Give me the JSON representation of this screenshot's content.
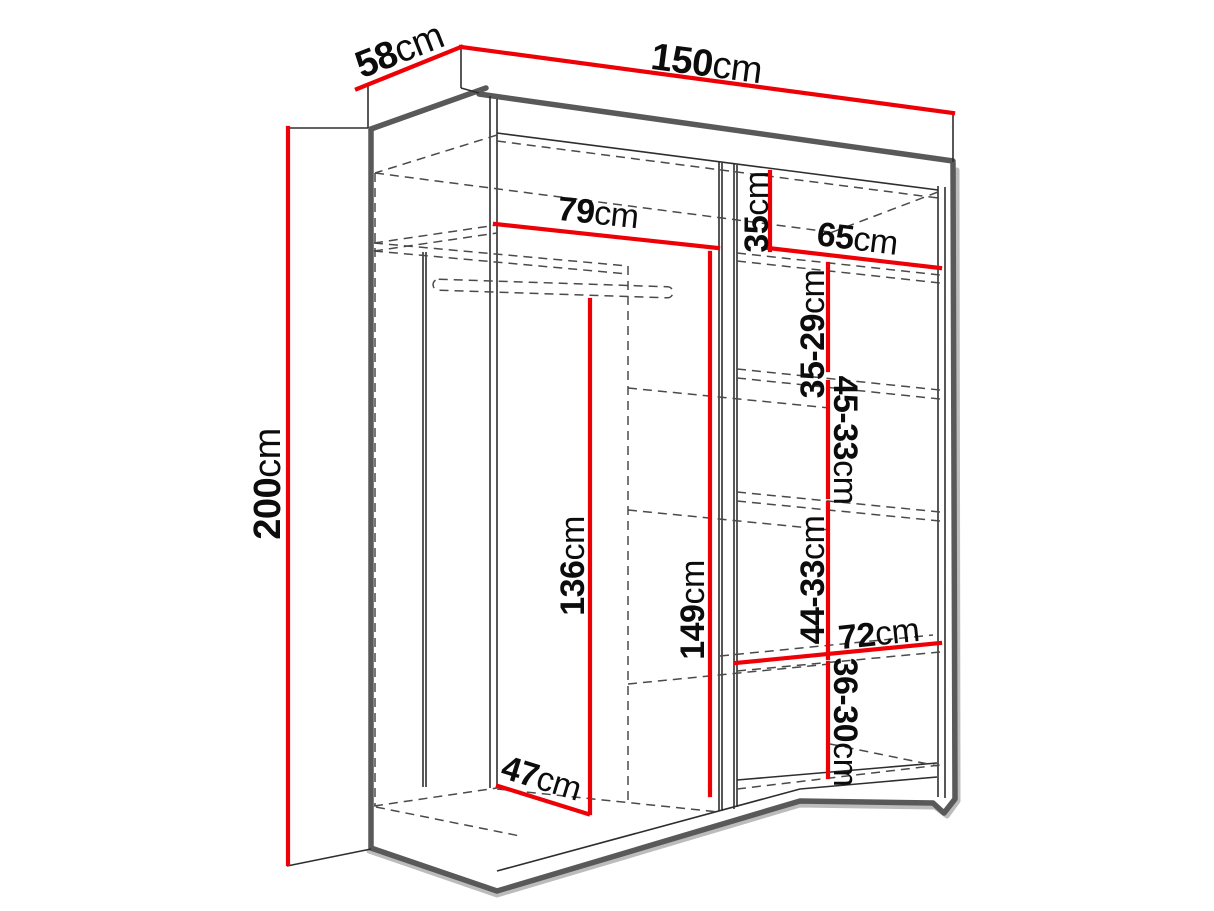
{
  "diagram": {
    "type": "furniture-dimension-diagram",
    "subject": "wardrobe interior line drawing with red dimension lines",
    "unit": "cm",
    "colors": {
      "dimension_line": "#ee0007",
      "outline": "#595959",
      "thin_line": "#2e2e2e",
      "hidden_line": "#4a4a4a",
      "label_text": "#0c0c0c",
      "background": "#ffffff"
    },
    "dims": {
      "width": {
        "value": "150",
        "unit": "cm"
      },
      "depth": {
        "value": "58",
        "unit": "cm"
      },
      "height": {
        "value": "200",
        "unit": "cm"
      },
      "left_top_width": {
        "value": "79",
        "unit": "cm"
      },
      "right_top_height": {
        "value": "35",
        "unit": "cm"
      },
      "right_width": {
        "value": "65",
        "unit": "cm"
      },
      "shelf_gap_1": {
        "value": "35-29",
        "unit": "cm"
      },
      "shelf_gap_2": {
        "value": "45-33",
        "unit": "cm"
      },
      "shelf_gap_3": {
        "value": "44-33",
        "unit": "cm"
      },
      "shelf_gap_4": {
        "value": "36-30",
        "unit": "cm"
      },
      "hanging_height": {
        "value": "136",
        "unit": "cm"
      },
      "left_inner_height": {
        "value": "149",
        "unit": "cm"
      },
      "lower_shelf_width": {
        "value": "72",
        "unit": "cm"
      },
      "floor_depth": {
        "value": "47",
        "unit": "cm"
      }
    }
  }
}
